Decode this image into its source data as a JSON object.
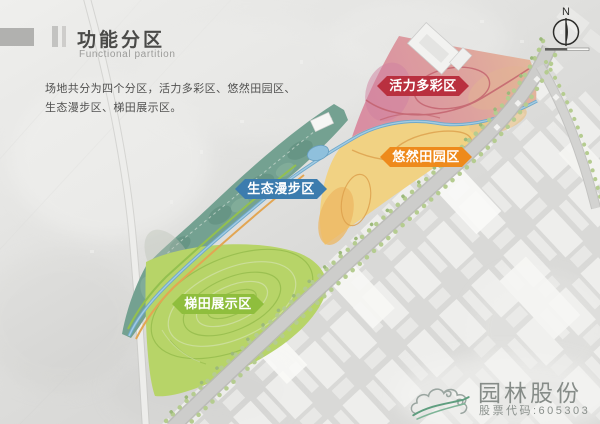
{
  "slide": {
    "title": "功能分区",
    "subtitle": "Functional partition",
    "description_line1": "场地共分为四个分区，活力多彩区、悠然田园区、",
    "description_line2": "生态漫步区、梯田展示区。"
  },
  "compass": {
    "north_label": "N"
  },
  "map": {
    "zones": [
      {
        "name": "vitality-colorful-zone",
        "label": "活力多彩区",
        "ribbon_color": "#b9303f",
        "area_color": "#dc93a3"
      },
      {
        "name": "leisure-pastoral-zone",
        "label": "悠然田园区",
        "ribbon_color": "#ee8a1c",
        "area_color": "#f1d283"
      },
      {
        "name": "eco-stroll-zone",
        "label": "生态漫步区",
        "ribbon_color": "#3c7cae",
        "area_color": "#74a191"
      },
      {
        "name": "terrace-display-zone",
        "label": "梯田展示区",
        "ribbon_color": "#8fbe3d",
        "area_color": "#b7d468"
      }
    ],
    "water_color": "#6ea9cc",
    "road_color": "#cdcdcb"
  },
  "logo": {
    "company_name": "园林股份",
    "stock_code": "股票代码:605303"
  }
}
